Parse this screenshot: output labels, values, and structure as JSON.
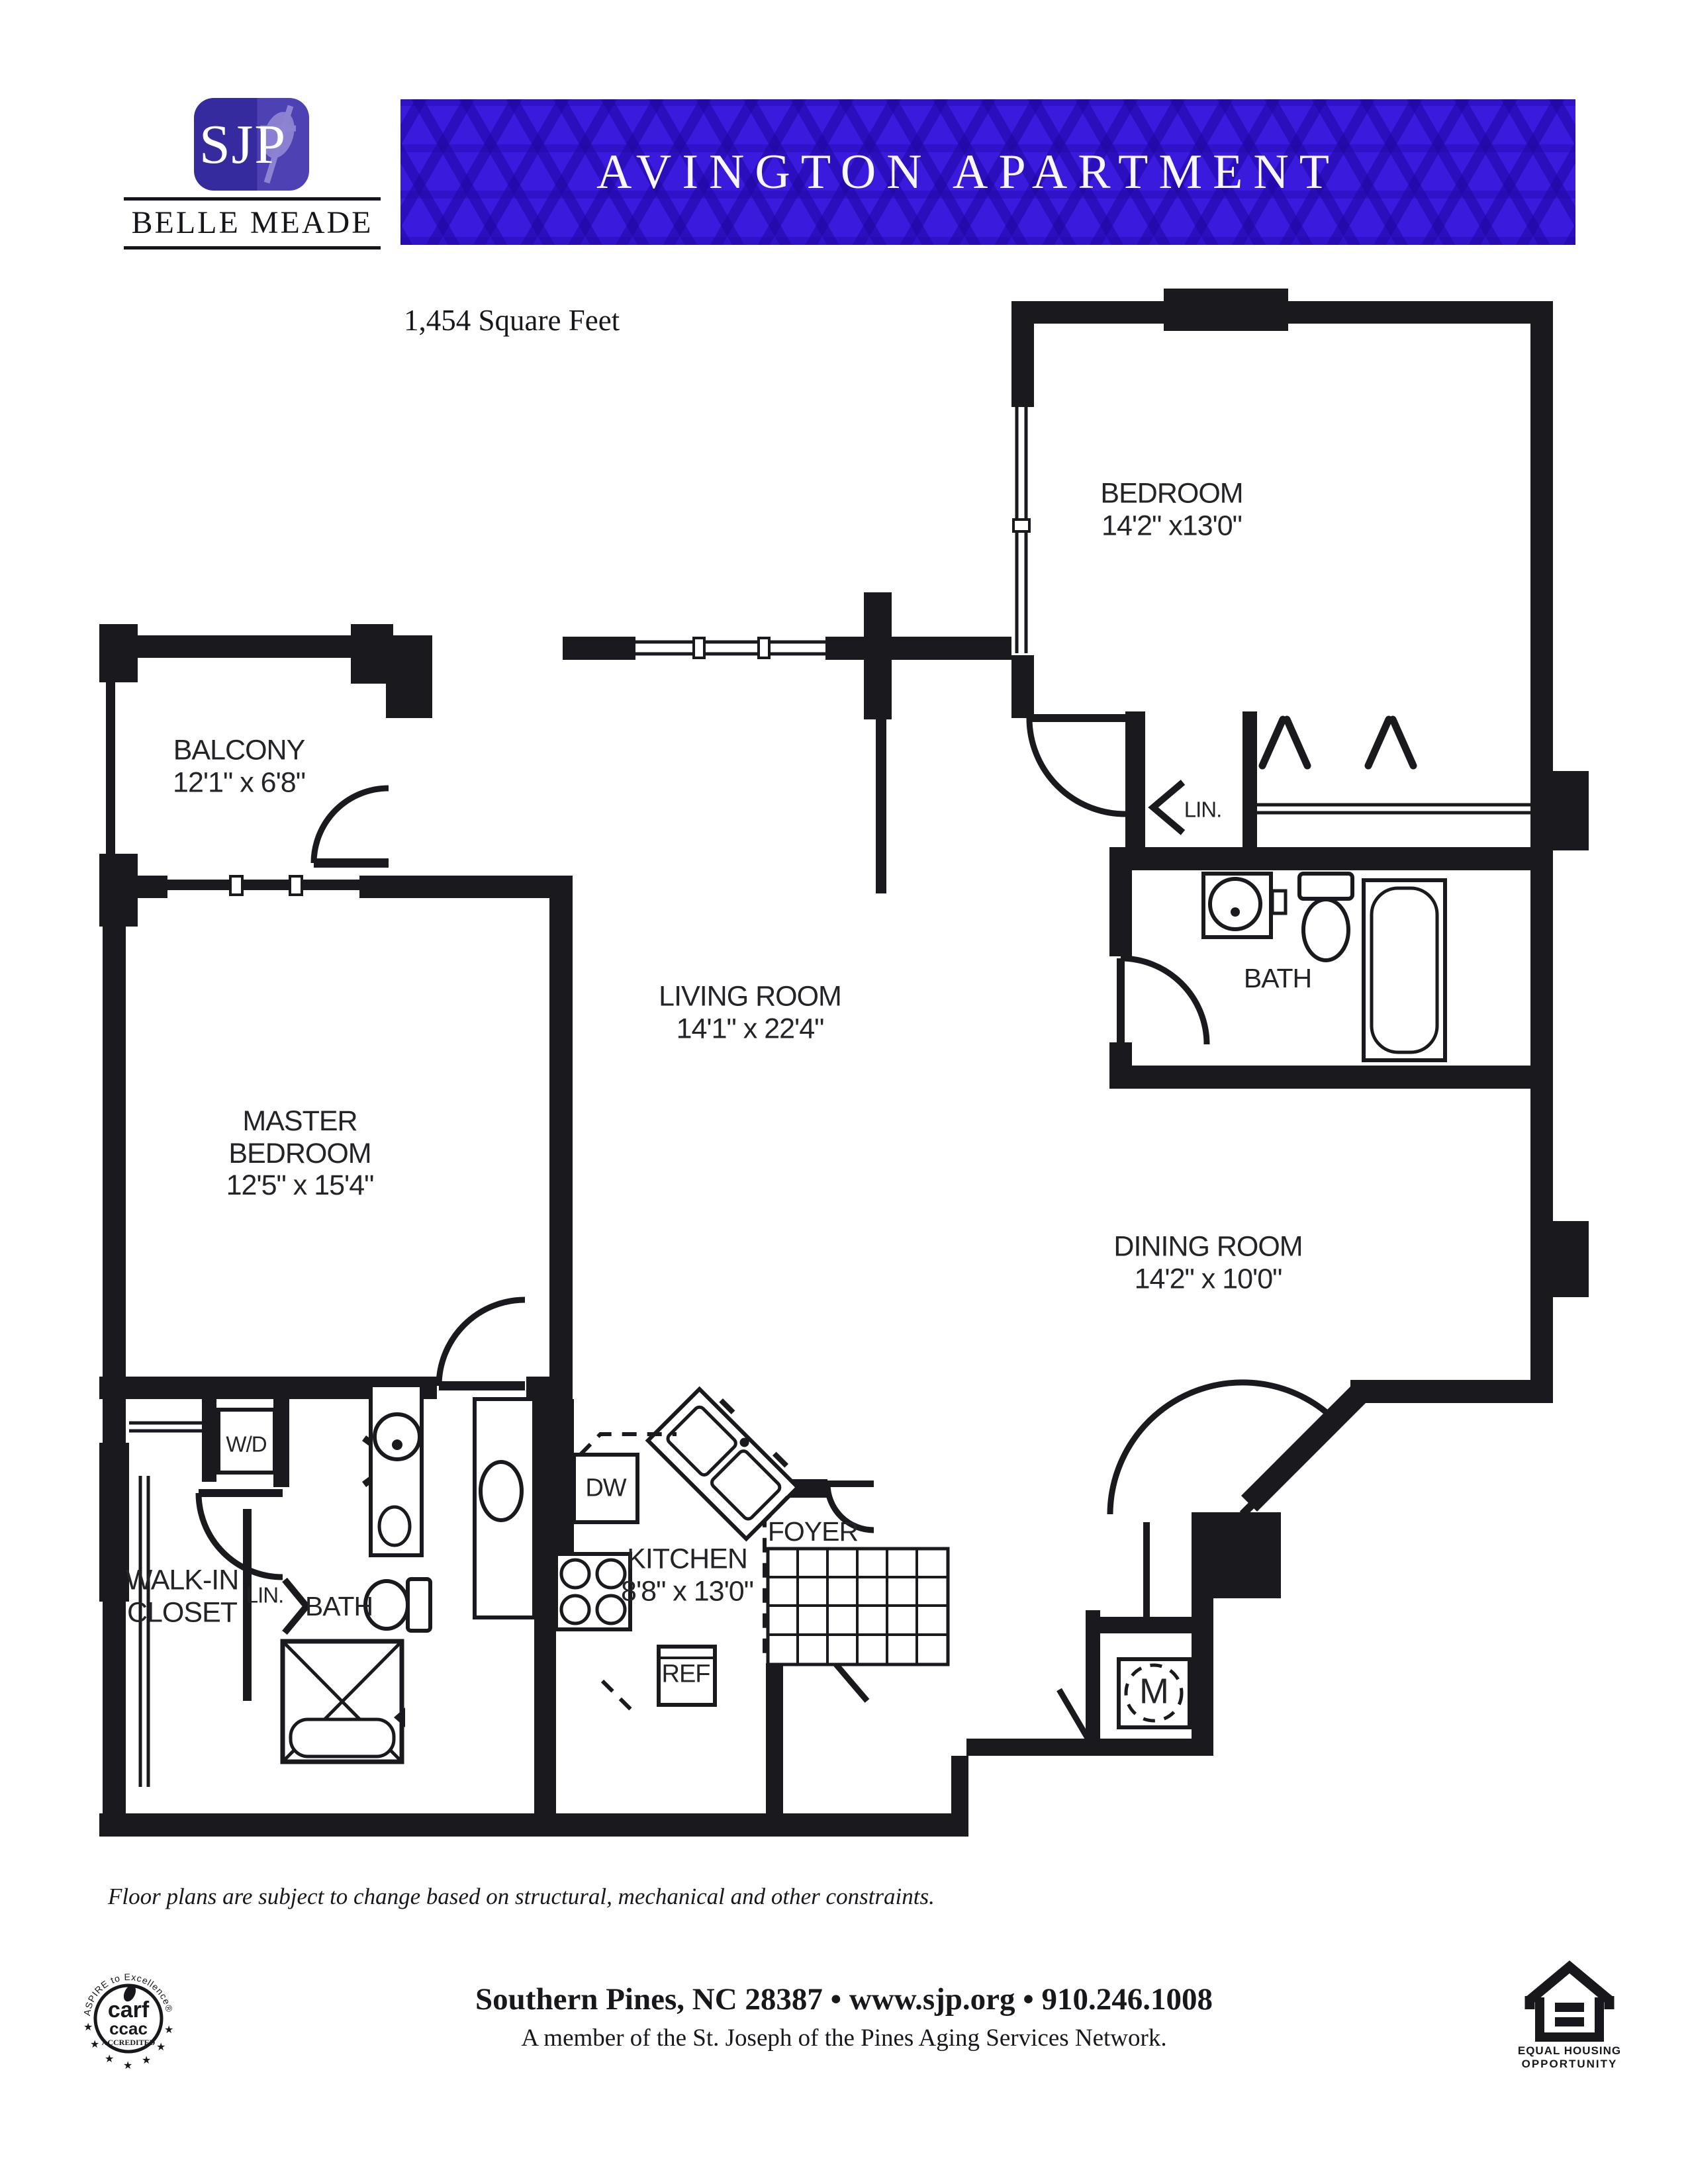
{
  "header": {
    "logo_monogram": "SJP",
    "brand": "BELLE MEADE",
    "banner_title": "AVINGTON APARTMENT",
    "square_feet": "1,454 Square Feet",
    "colors": {
      "banner_bg": "#3a1add",
      "banner_pattern": "#2f10b0",
      "logo_bg": "#362b9e"
    }
  },
  "floorplan": {
    "rooms": {
      "bedroom": {
        "name": "BEDROOM",
        "dims": "14'2\" x13'0\""
      },
      "balcony": {
        "name": "BALCONY",
        "dims": "12'1\" x 6'8\""
      },
      "living": {
        "name": "LIVING ROOM",
        "dims": "14'1\" x 22'4\""
      },
      "master": {
        "line1": "MASTER",
        "line2": "BEDROOM",
        "dims": "12'5\" x 15'4\""
      },
      "dining": {
        "name": "DINING ROOM",
        "dims": "14'2\" x 10'0\""
      },
      "kitchen": {
        "name": "KITCHEN",
        "dims": "8'8\" x 13'0\""
      },
      "bath_upper": {
        "name": "BATH"
      },
      "bath_master": {
        "name": "BATH"
      },
      "walkin": {
        "line1": "WALK-IN",
        "line2": "CLOSET"
      },
      "foyer": {
        "name": "FOYER"
      },
      "lin_upper": {
        "name": "LIN."
      },
      "lin_master": {
        "name": "LIN."
      },
      "wd": {
        "name": "W/D"
      },
      "dw": {
        "name": "DW"
      },
      "ref": {
        "name": "REF"
      },
      "mech": {
        "name": "M"
      }
    }
  },
  "disclaimer": "Floor plans are subject to change based on structural, mechanical and other constraints.",
  "footer": {
    "address_line": "Southern Pines, NC 28387  •  www.sjp.org  •  910.246.1008",
    "network_line": "A member of the St. Joseph of the Pines Aging Services Network.",
    "carf_seal": {
      "arc_text": "ASPIRE to Excellence®",
      "line1": "carf",
      "line2": "ccac",
      "line3": "ACCREDITED",
      "star": "★"
    },
    "equal_housing": {
      "line1": "EQUAL HOUSING",
      "line2": "OPPORTUNITY"
    }
  }
}
